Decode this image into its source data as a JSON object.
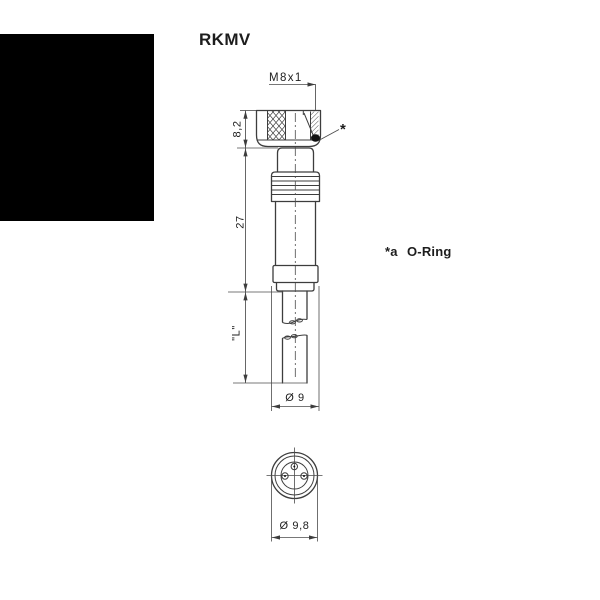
{
  "title": "RKMV",
  "drawing": {
    "thread_label": "M8x1",
    "oring_pointer": "*",
    "dims": {
      "nut_height": "8,2",
      "body_length": "27",
      "cable_length": "\"L\"",
      "body_diameter": "Ø 9",
      "face_diameter": "Ø 9,8"
    },
    "note": {
      "marker": "*a",
      "text": "O-Ring"
    }
  },
  "colors": {
    "line": "#3d3d3d",
    "text": "#1d1d1d",
    "background": "#ffffff",
    "redaction_block": "#000000",
    "oring_fill": "#111111"
  }
}
